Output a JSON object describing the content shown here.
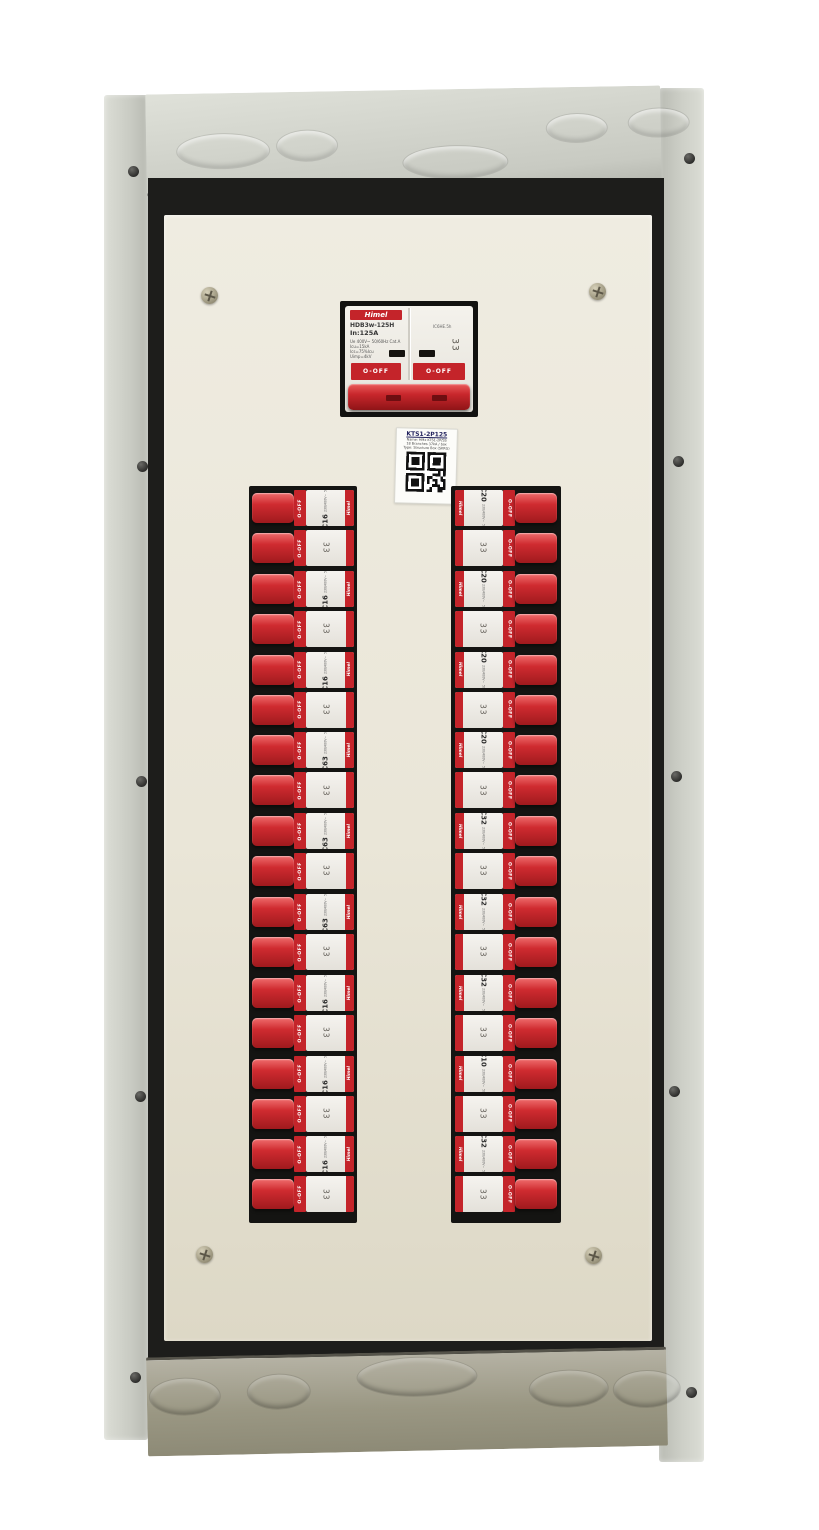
{
  "panel": {
    "name": "distribution-board"
  },
  "main_breaker": {
    "brand": "Himel",
    "model": "HDB3w-125H",
    "rating": "In:125A",
    "cert": "IC6HE.5h",
    "specs": [
      "Ue 400V~  50/60Hz  Cat.A",
      "Icu=15kA",
      "Ics=75%Icu",
      "Uimp=4kV"
    ],
    "mark": "33",
    "off": "O-OFF"
  },
  "qr_label": {
    "title": "KTS1-2P125",
    "lines": [
      "Name: HMx KTS1-2P/SS",
      "18 Branches 37kA / box",
      "Type: Structure Box (SKRG)"
    ]
  },
  "branch_common": {
    "brand": "Himel",
    "model": "HDB3wN",
    "voltage": "230/400V~",
    "freq": "50/60Hz",
    "breaking": "6000",
    "mark": "33",
    "off": "O-OFF"
  },
  "branch_left": [
    {
      "rating": "C16"
    },
    {
      "rating": "C16"
    },
    {
      "rating": "C16"
    },
    {
      "rating": "C63"
    },
    {
      "rating": "C63"
    },
    {
      "rating": "C63"
    },
    {
      "rating": "C16"
    },
    {
      "rating": "C16"
    },
    {
      "rating": "C16"
    }
  ],
  "branch_right": [
    {
      "rating": "C20"
    },
    {
      "rating": "C20"
    },
    {
      "rating": "C20"
    },
    {
      "rating": "C20"
    },
    {
      "rating": "C32"
    },
    {
      "rating": "C32"
    },
    {
      "rating": "C32"
    },
    {
      "rating": "C10"
    },
    {
      "rating": "C32"
    }
  ]
}
